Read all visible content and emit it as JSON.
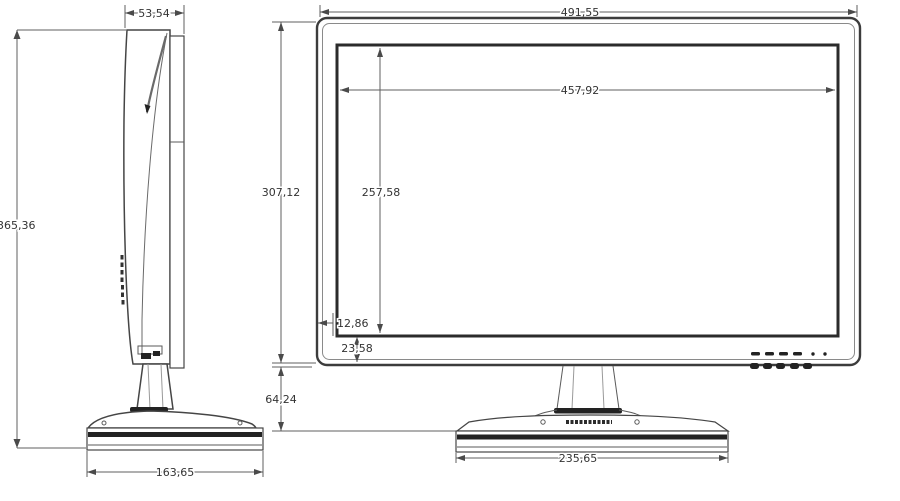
{
  "drawing": {
    "kind": "monitor-dimension-drawing",
    "background": "#ffffff",
    "line_color": "#454545",
    "dimension_line_color": "#5f5f5f",
    "text_color": "#333333",
    "accent_dark": "#222222",
    "side_view": {
      "name": "side view",
      "dims": {
        "depth_top": "53,54",
        "total_height": "365,36",
        "base_depth": "163,65"
      }
    },
    "front_view": {
      "name": "front view",
      "dims": {
        "total_width": "491,55",
        "screen_width": "457,92",
        "screen_height": "257,58",
        "total_panel_height": "307,12",
        "screen_side_offset": "12,86",
        "screen_bottom_offset": "23,58",
        "stand_height": "64,24",
        "base_width": "235,65"
      },
      "controls": {
        "button_dashes": 4,
        "indicator_dots": 2,
        "under_bezel_buttons": 5
      }
    }
  }
}
